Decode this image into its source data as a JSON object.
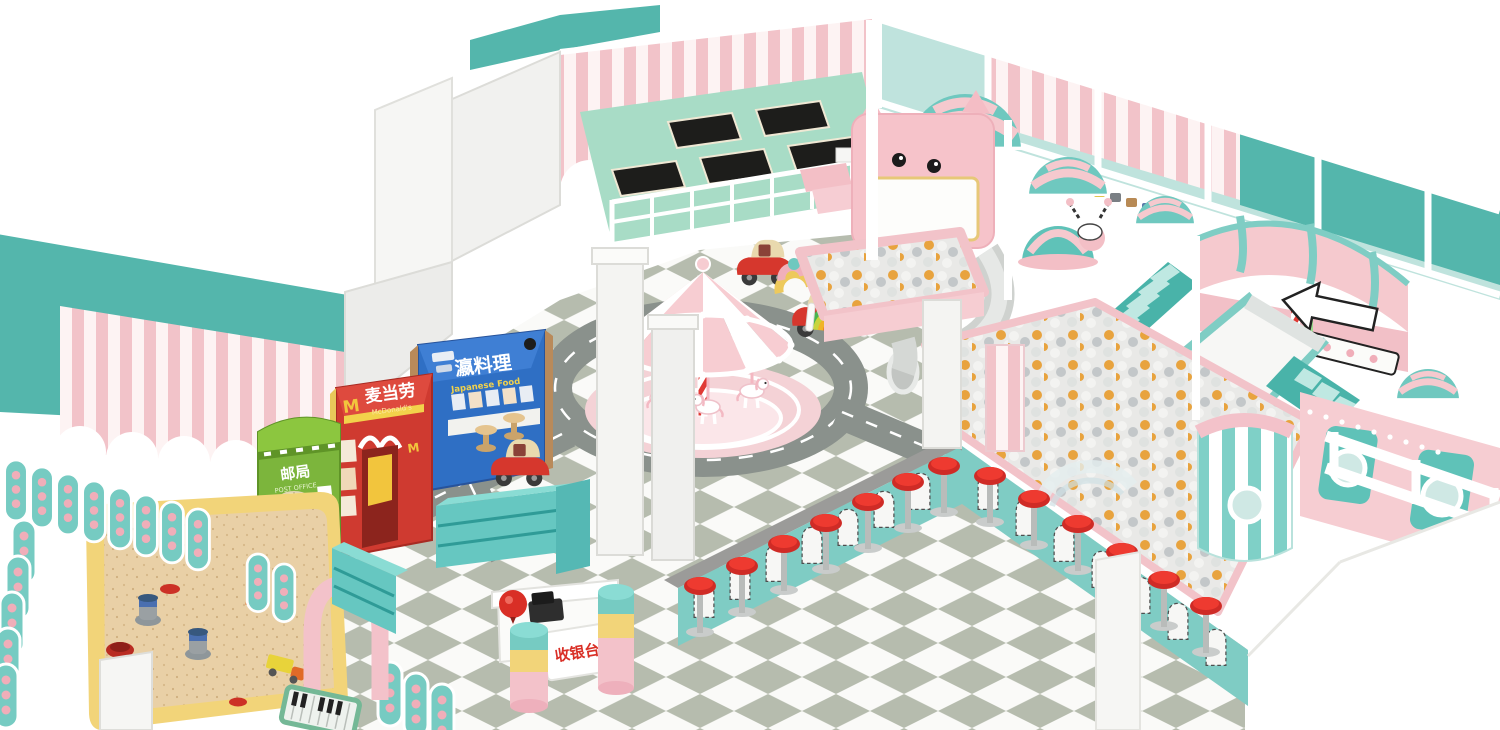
{
  "scene": {
    "description_visible": "",
    "signs": {
      "post_office": {
        "cn": "邮局",
        "en": "POST OFFICE"
      },
      "mcdonalds": {
        "cn": "麦当劳",
        "en": "McDonald's",
        "logo": "M"
      },
      "japanese_restaurant": {
        "cn": "瀛料理",
        "en": "Japanese Food"
      },
      "cashier_desk": {
        "cn": "收银台"
      }
    },
    "palette": {
      "teal_wall": "#54b6ac",
      "mint_fence": "#76cbc2",
      "pink_stripe": "#f2c3c9",
      "pink_structure": "#f5c9ce",
      "floor_white": "#fafaf8",
      "floor_sage": "#b6bcae",
      "road_gray": "#8a918c",
      "red": "#dd3b30",
      "shop_green": "#7cb53c",
      "shop_blue": "#2f6fc4",
      "sand": "#e9d0a6",
      "sand_border": "#f2d479",
      "ball_orange": "#e8a33e",
      "ball_gray": "#c3c7c9",
      "ball_white": "#f3f3f1",
      "trampoline_black": "#1d1d1b",
      "trampoline_floor": "#a8dcc6"
    },
    "elements": [
      "trampoline-area",
      "carousel",
      "toy-cars",
      "ball-pits",
      "spiral-tube-slide",
      "wide-slide",
      "striped-domes",
      "diner-counter-bar-stools",
      "sand-pit",
      "shop-street",
      "cashier-desk",
      "shoe-shelves",
      "rainbow-climber",
      "piano-mat"
    ]
  }
}
